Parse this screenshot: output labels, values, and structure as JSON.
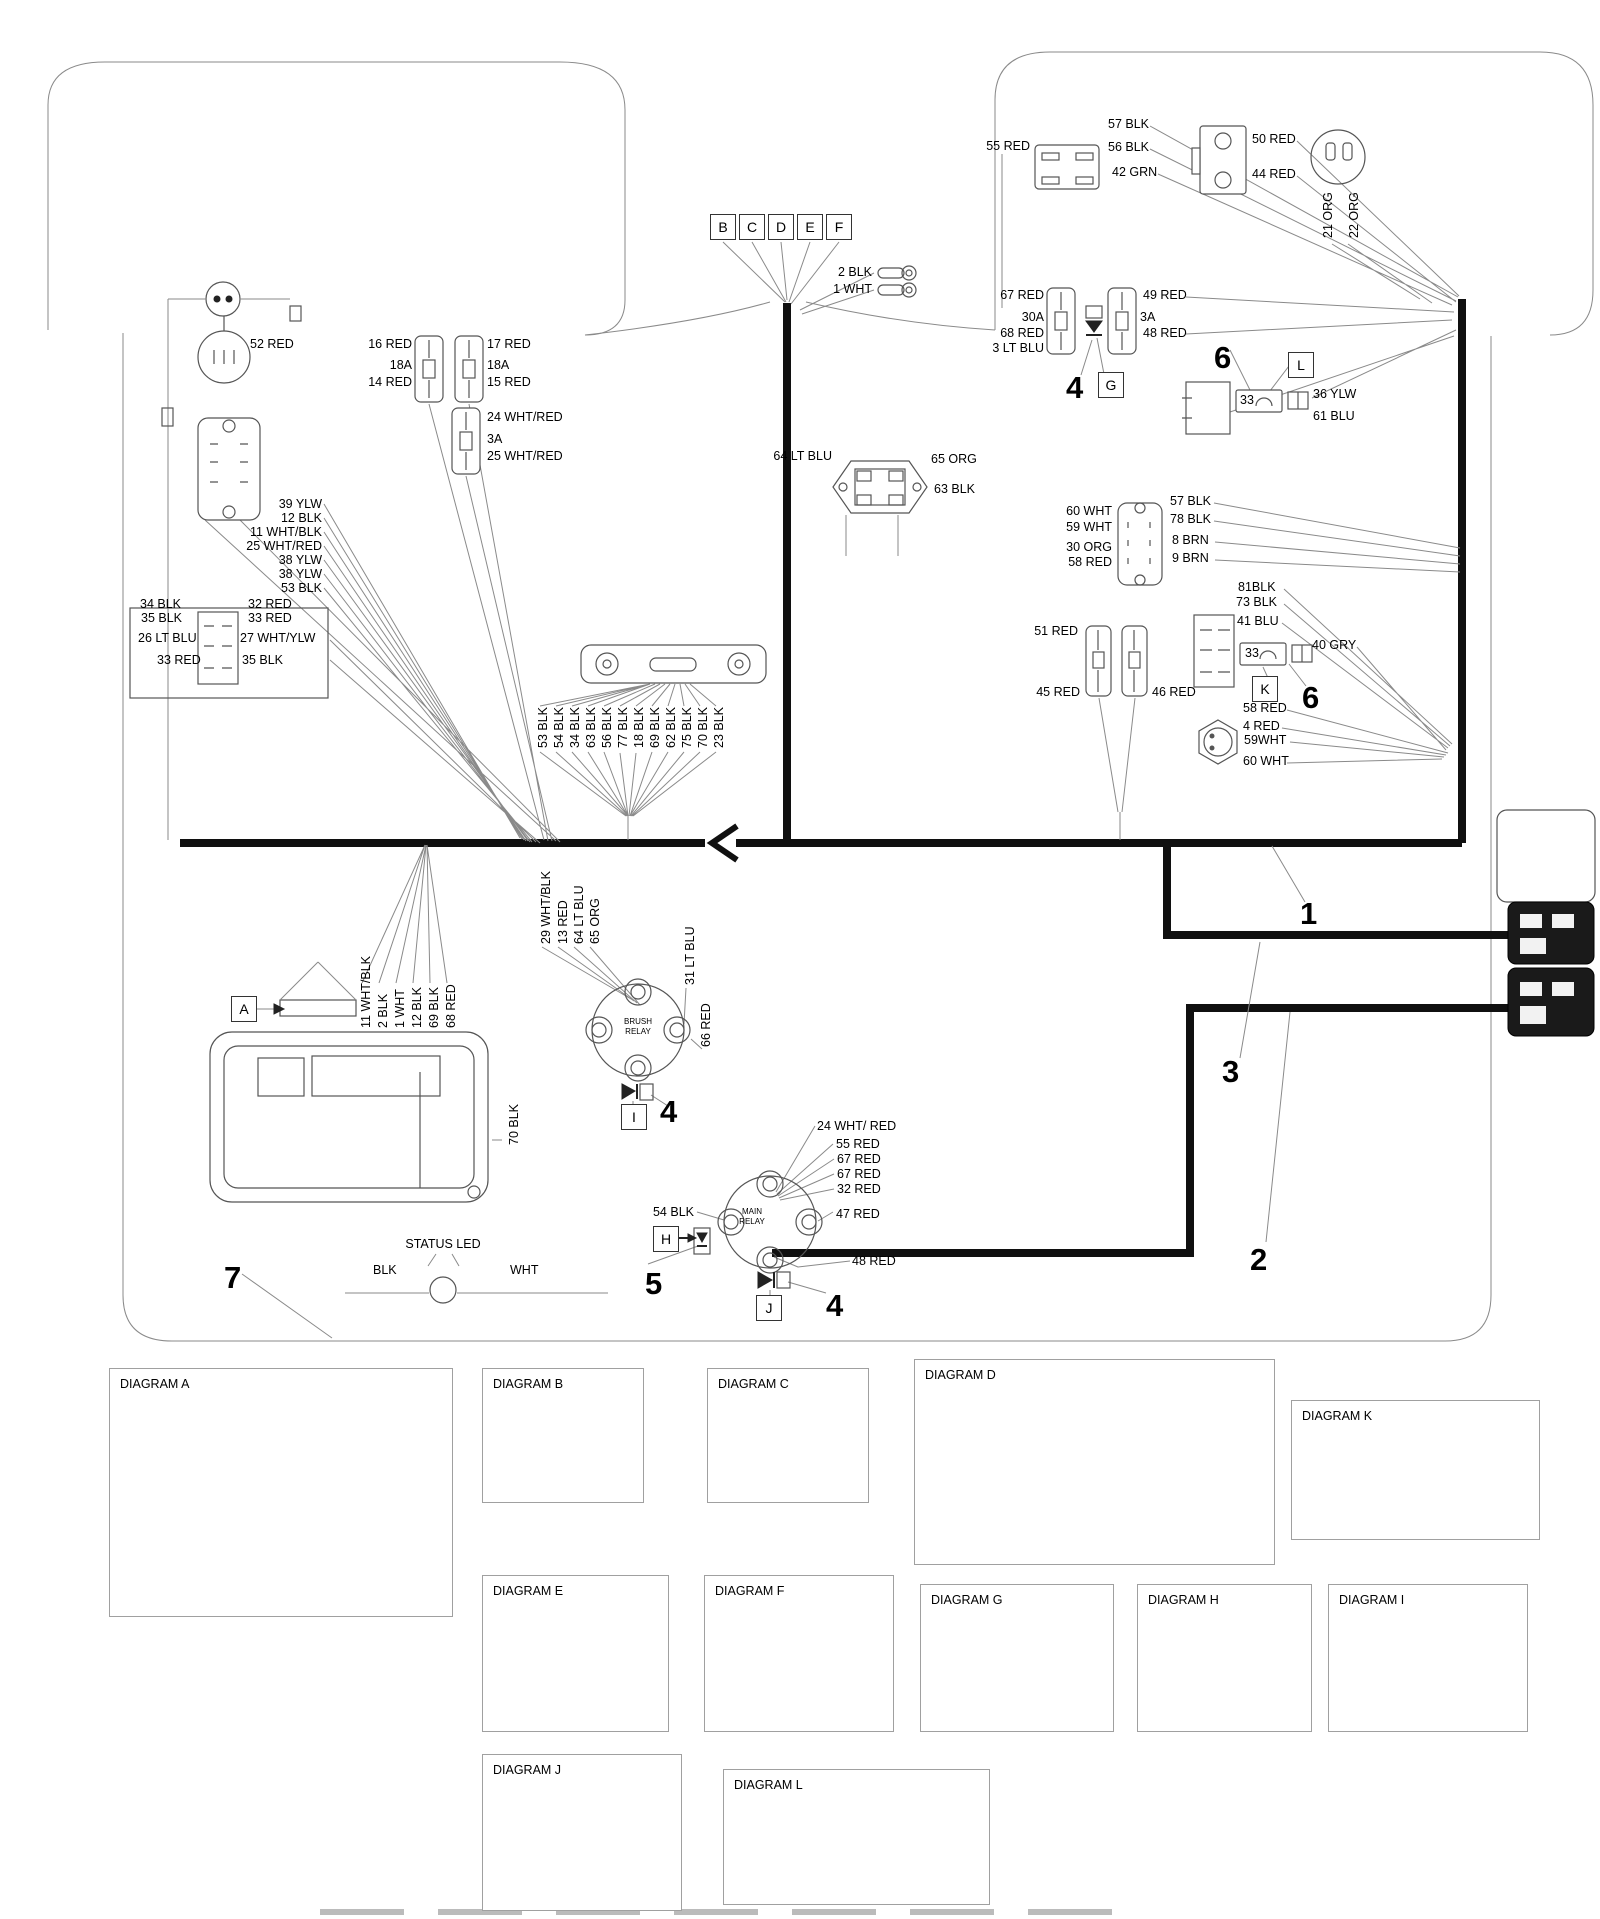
{
  "colors": {
    "thick_wire": "#101010",
    "thin_wire": "#8a8a8a",
    "text": "#000000",
    "background": "#ffffff"
  },
  "refs": [
    {
      "t": "A",
      "x": 231,
      "y": 996
    },
    {
      "t": "B",
      "x": 710,
      "y": 214
    },
    {
      "t": "C",
      "x": 739,
      "y": 214
    },
    {
      "t": "D",
      "x": 768,
      "y": 214
    },
    {
      "t": "E",
      "x": 797,
      "y": 214
    },
    {
      "t": "F",
      "x": 826,
      "y": 214
    },
    {
      "t": "G",
      "x": 1098,
      "y": 372
    },
    {
      "t": "H",
      "x": 653,
      "y": 1226
    },
    {
      "t": "I",
      "x": 621,
      "y": 1104
    },
    {
      "t": "J",
      "x": 756,
      "y": 1295
    },
    {
      "t": "K",
      "x": 1252,
      "y": 676
    },
    {
      "t": "L",
      "x": 1288,
      "y": 352
    }
  ],
  "labels": [
    {
      "t": "2 BLK",
      "x": 872,
      "y": 266,
      "a": "r"
    },
    {
      "t": "1 WHT",
      "x": 872,
      "y": 283,
      "a": "r"
    },
    {
      "t": "55 RED",
      "x": 1030,
      "y": 140,
      "a": "r"
    },
    {
      "t": "57 BLK",
      "x": 1108,
      "y": 118
    },
    {
      "t": "56 BLK",
      "x": 1108,
      "y": 141
    },
    {
      "t": "42 GRN",
      "x": 1112,
      "y": 166
    },
    {
      "t": "50 RED",
      "x": 1252,
      "y": 133
    },
    {
      "t": "44 RED",
      "x": 1252,
      "y": 168
    },
    {
      "t": "21 ORG",
      "x": 1322,
      "y": 238,
      "r": 1
    },
    {
      "t": "22 ORG",
      "x": 1348,
      "y": 238,
      "r": 1
    },
    {
      "t": "67 RED",
      "x": 1044,
      "y": 289,
      "a": "r"
    },
    {
      "t": "30A",
      "x": 1044,
      "y": 311,
      "a": "r"
    },
    {
      "t": "68 RED",
      "x": 1044,
      "y": 327,
      "a": "r"
    },
    {
      "t": "3 LT BLU",
      "x": 1044,
      "y": 342,
      "a": "r"
    },
    {
      "t": "49 RED",
      "x": 1143,
      "y": 289
    },
    {
      "t": "3A",
      "x": 1140,
      "y": 311
    },
    {
      "t": "48 RED",
      "x": 1143,
      "y": 327
    },
    {
      "t": "33",
      "x": 1240,
      "y": 394,
      "n": "fuse-33-label"
    },
    {
      "t": "36 YLW",
      "x": 1313,
      "y": 388
    },
    {
      "t": "61 BLU",
      "x": 1313,
      "y": 410
    },
    {
      "t": "64 LT BLU",
      "x": 832,
      "y": 450,
      "a": "r"
    },
    {
      "t": "65 ORG",
      "x": 931,
      "y": 453
    },
    {
      "t": "63 BLK",
      "x": 934,
      "y": 483
    },
    {
      "t": "60 WHT",
      "x": 1112,
      "y": 505,
      "a": "r"
    },
    {
      "t": "59 WHT",
      "x": 1112,
      "y": 521,
      "a": "r"
    },
    {
      "t": "30 ORG",
      "x": 1112,
      "y": 541,
      "a": "r"
    },
    {
      "t": "58 RED",
      "x": 1112,
      "y": 556,
      "a": "r"
    },
    {
      "t": "57 BLK",
      "x": 1170,
      "y": 495
    },
    {
      "t": "78 BLK",
      "x": 1170,
      "y": 513
    },
    {
      "t": "8 BRN",
      "x": 1172,
      "y": 534
    },
    {
      "t": "9 BRN",
      "x": 1172,
      "y": 552
    },
    {
      "t": "81BLK",
      "x": 1238,
      "y": 581
    },
    {
      "t": "73 BLK",
      "x": 1236,
      "y": 596
    },
    {
      "t": "41 BLU",
      "x": 1237,
      "y": 615
    },
    {
      "t": "33",
      "x": 1245,
      "y": 647,
      "n": "fuse-33-label"
    },
    {
      "t": "40 GRY",
      "x": 1312,
      "y": 639
    },
    {
      "t": "58 RED",
      "x": 1243,
      "y": 702
    },
    {
      "t": "4 RED",
      "x": 1243,
      "y": 720
    },
    {
      "t": "59WHT",
      "x": 1244,
      "y": 734
    },
    {
      "t": "60 WHT",
      "x": 1243,
      "y": 755
    },
    {
      "t": "51 RED",
      "x": 1078,
      "y": 625,
      "a": "r"
    },
    {
      "t": "45 RED",
      "x": 1080,
      "y": 686,
      "a": "r"
    },
    {
      "t": "46 RED",
      "x": 1152,
      "y": 686
    },
    {
      "t": "52 RED",
      "x": 250,
      "y": 338
    },
    {
      "t": "16 RED",
      "x": 412,
      "y": 338,
      "a": "r"
    },
    {
      "t": "18A",
      "x": 412,
      "y": 359,
      "a": "r"
    },
    {
      "t": "14 RED",
      "x": 412,
      "y": 376,
      "a": "r"
    },
    {
      "t": "17 RED",
      "x": 487,
      "y": 338
    },
    {
      "t": "18A",
      "x": 487,
      "y": 359
    },
    {
      "t": "15 RED",
      "x": 487,
      "y": 376
    },
    {
      "t": "24 WHT/RED",
      "x": 487,
      "y": 411
    },
    {
      "t": "3A",
      "x": 487,
      "y": 433
    },
    {
      "t": "25 WHT/RED",
      "x": 487,
      "y": 450
    },
    {
      "t": "39 YLW",
      "x": 322,
      "y": 498,
      "a": "r"
    },
    {
      "t": "12 BLK",
      "x": 322,
      "y": 512,
      "a": "r"
    },
    {
      "t": "11 WHT/BLK",
      "x": 322,
      "y": 526,
      "a": "r"
    },
    {
      "t": "25 WHT/RED",
      "x": 322,
      "y": 540,
      "a": "r"
    },
    {
      "t": "38 YLW",
      "x": 322,
      "y": 554,
      "a": "r"
    },
    {
      "t": "38 YLW",
      "x": 322,
      "y": 568,
      "a": "r"
    },
    {
      "t": "53 BLK",
      "x": 322,
      "y": 582,
      "a": "r"
    },
    {
      "t": "34 BLK",
      "x": 140,
      "y": 598
    },
    {
      "t": "35 BLK",
      "x": 141,
      "y": 612
    },
    {
      "t": "26 LT BLU",
      "x": 138,
      "y": 632
    },
    {
      "t": "33 RED",
      "x": 157,
      "y": 654
    },
    {
      "t": "32 RED",
      "x": 248,
      "y": 598
    },
    {
      "t": "33 RED",
      "x": 248,
      "y": 612
    },
    {
      "t": "27 WHT/YLW",
      "x": 240,
      "y": 632
    },
    {
      "t": "35 BLK",
      "x": 242,
      "y": 654
    },
    {
      "t": "53 BLK",
      "x": 537,
      "y": 748,
      "r": 1
    },
    {
      "t": "54 BLK",
      "x": 553,
      "y": 748,
      "r": 1
    },
    {
      "t": "34 BLK",
      "x": 569,
      "y": 748,
      "r": 1
    },
    {
      "t": "63 BLK",
      "x": 585,
      "y": 748,
      "r": 1
    },
    {
      "t": "56 BLK",
      "x": 601,
      "y": 748,
      "r": 1
    },
    {
      "t": "77 BLK",
      "x": 617,
      "y": 748,
      "r": 1
    },
    {
      "t": "18 BLK",
      "x": 633,
      "y": 748,
      "r": 1
    },
    {
      "t": "69 BLK",
      "x": 649,
      "y": 748,
      "r": 1
    },
    {
      "t": "62 BLK",
      "x": 665,
      "y": 748,
      "r": 1
    },
    {
      "t": "75 BLK",
      "x": 681,
      "y": 748,
      "r": 1
    },
    {
      "t": "70 BLK",
      "x": 697,
      "y": 748,
      "r": 1
    },
    {
      "t": "23 BLK",
      "x": 713,
      "y": 748,
      "r": 1
    },
    {
      "t": "11 WHT/BLK",
      "x": 360,
      "y": 1028,
      "r": 1
    },
    {
      "t": "2 BLK",
      "x": 377,
      "y": 1028,
      "r": 1
    },
    {
      "t": "1 WHT",
      "x": 394,
      "y": 1028,
      "r": 1
    },
    {
      "t": "12 BLK",
      "x": 411,
      "y": 1028,
      "r": 1
    },
    {
      "t": "69 BLK",
      "x": 428,
      "y": 1028,
      "r": 1
    },
    {
      "t": "68 RED",
      "x": 445,
      "y": 1028,
      "r": 1
    },
    {
      "t": "70 BLK",
      "x": 508,
      "y": 1145,
      "r": 1
    },
    {
      "t": "STATUS LED",
      "x": 443,
      "y": 1238,
      "a": "c",
      "n": "status-led-label"
    },
    {
      "t": "BLK",
      "x": 373,
      "y": 1264
    },
    {
      "t": "WHT",
      "x": 510,
      "y": 1264
    },
    {
      "t": "29 WHT/BLK",
      "x": 540,
      "y": 944,
      "r": 1
    },
    {
      "t": "13 RED",
      "x": 557,
      "y": 944,
      "r": 1
    },
    {
      "t": "64 LT BLU",
      "x": 573,
      "y": 944,
      "r": 1
    },
    {
      "t": "65 ORG",
      "x": 589,
      "y": 944,
      "r": 1
    },
    {
      "t": "31 LT BLU",
      "x": 684,
      "y": 985,
      "r": 1
    },
    {
      "t": "66 RED",
      "x": 700,
      "y": 1047,
      "r": 1
    },
    {
      "t": "BRUSH",
      "x": 638,
      "y": 1018,
      "cls": "tiny",
      "n": "brush-relay-label"
    },
    {
      "t": "RELAY",
      "x": 638,
      "y": 1028,
      "cls": "tiny",
      "n": "brush-relay-label"
    },
    {
      "t": "24 WHT/ RED",
      "x": 817,
      "y": 1120
    },
    {
      "t": "55 RED",
      "x": 836,
      "y": 1138
    },
    {
      "t": "67 RED",
      "x": 837,
      "y": 1153
    },
    {
      "t": "67 RED",
      "x": 837,
      "y": 1168
    },
    {
      "t": "32 RED",
      "x": 837,
      "y": 1183
    },
    {
      "t": "47 RED",
      "x": 836,
      "y": 1208
    },
    {
      "t": "54 BLK",
      "x": 694,
      "y": 1206,
      "a": "r"
    },
    {
      "t": "48 RED",
      "x": 852,
      "y": 1255
    },
    {
      "t": "MAIN",
      "x": 752,
      "y": 1208,
      "cls": "tiny",
      "n": "main-relay-label"
    },
    {
      "t": "RELAY",
      "x": 752,
      "y": 1218,
      "cls": "tiny",
      "n": "main-relay-label"
    },
    {
      "t": "1",
      "x": 1300,
      "y": 898,
      "cls": "big",
      "n": "callout-1"
    },
    {
      "t": "2",
      "x": 1250,
      "y": 1244,
      "cls": "big",
      "n": "callout-2"
    },
    {
      "t": "3",
      "x": 1222,
      "y": 1056,
      "cls": "big",
      "n": "callout-3"
    },
    {
      "t": "4",
      "x": 1066,
      "y": 372,
      "cls": "big",
      "n": "callout-4"
    },
    {
      "t": "4",
      "x": 660,
      "y": 1096,
      "cls": "big",
      "n": "callout-4"
    },
    {
      "t": "4",
      "x": 826,
      "y": 1290,
      "cls": "big",
      "n": "callout-4"
    },
    {
      "t": "5",
      "x": 645,
      "y": 1268,
      "cls": "big",
      "n": "callout-5"
    },
    {
      "t": "6",
      "x": 1214,
      "y": 342,
      "cls": "big",
      "n": "callout-6"
    },
    {
      "t": "6",
      "x": 1302,
      "y": 682,
      "cls": "big",
      "n": "callout-6"
    },
    {
      "t": "7",
      "x": 224,
      "y": 1262,
      "cls": "big",
      "n": "callout-7"
    },
    {
      "t": "80 WHT/GRN",
      "x": 280,
      "y": 1438,
      "a": "r"
    },
    {
      "t": "40 GRY",
      "x": 280,
      "y": 1453,
      "a": "r"
    },
    {
      "t": "72RED",
      "x": 280,
      "y": 1468,
      "a": "r"
    },
    {
      "t": "42 DK GRN",
      "x": 280,
      "y": 1483,
      "a": "r"
    },
    {
      "t": "28 WHT/ORG",
      "x": 280,
      "y": 1498,
      "a": "r"
    },
    {
      "t": "10 GRN",
      "x": 280,
      "y": 1513,
      "a": "r"
    },
    {
      "t": "41 DK BLU",
      "x": 280,
      "y": 1528,
      "a": "r"
    },
    {
      "t": "81 BLK",
      "x": 280,
      "y": 1543,
      "a": "r"
    },
    {
      "t": "36 YLW",
      "x": 354,
      "y": 1430
    },
    {
      "t": "31 LT BLU",
      "x": 354,
      "y": 1452
    },
    {
      "t": "43 RED",
      "x": 354,
      "y": 1472
    },
    {
      "t": "7 BRN",
      "x": 354,
      "y": 1493
    },
    {
      "t": "79 ORG",
      "x": 354,
      "y": 1512
    },
    {
      "t": "61 BLU",
      "x": 354,
      "y": 1538
    },
    {
      "t": "17 RED",
      "x": 580,
      "y": 1394
    },
    {
      "t": "19 BLK",
      "x": 580,
      "y": 1460
    },
    {
      "t": "16 RED",
      "x": 800,
      "y": 1394
    },
    {
      "t": "20 BLK",
      "x": 800,
      "y": 1460
    },
    {
      "t": "62 BLK",
      "x": 1063,
      "y": 1403,
      "a": "r"
    },
    {
      "t": "28 WHT/ORG",
      "x": 1063,
      "y": 1424,
      "a": "r"
    },
    {
      "t": "8 BRN",
      "x": 1063,
      "y": 1443,
      "a": "r"
    },
    {
      "t": "30 WHT",
      "x": 1063,
      "y": 1461,
      "a": "r"
    },
    {
      "t": "26 LT BLU",
      "x": 1063,
      "y": 1479,
      "a": "r"
    },
    {
      "t": "23 BLK",
      "x": 1063,
      "y": 1501,
      "a": "r"
    },
    {
      "t": "39 YLW",
      "x": 1170,
      "y": 1400
    },
    {
      "t": "29 WHT/BLK",
      "x": 1170,
      "y": 1421
    },
    {
      "t": "7 BRN",
      "x": 1172,
      "y": 1443
    },
    {
      "t": "78 BLK",
      "x": 1172,
      "y": 1461
    },
    {
      "t": "27 WHT/YLW",
      "x": 1170,
      "y": 1481
    },
    {
      "t": "22 ORG",
      "x": 1170,
      "y": 1501
    },
    {
      "t": "7",
      "x": 1090,
      "y": 1416
    },
    {
      "t": "6",
      "x": 1120,
      "y": 1416
    },
    {
      "t": "12",
      "x": 1082,
      "y": 1495
    },
    {
      "t": "1",
      "x": 1124,
      "y": 1495
    },
    {
      "t": "73 BLK",
      "x": 1363,
      "y": 1428,
      "a": "r"
    },
    {
      "t": "81BLK",
      "x": 1363,
      "y": 1456,
      "a": "r"
    },
    {
      "t": "41 BLU",
      "x": 1430,
      "y": 1426
    },
    {
      "t": "33",
      "x": 1426,
      "y": 1461,
      "n": "fuse-33-label"
    },
    {
      "t": "40 GRY",
      "x": 1492,
      "y": 1458
    },
    {
      "t": "67619",
      "x": 1424,
      "y": 1484
    },
    {
      "t": "3 BLU",
      "x": 532,
      "y": 1588,
      "a": "r"
    },
    {
      "t": "4 RED",
      "x": 532,
      "y": 1606,
      "a": "r"
    },
    {
      "t": "10 GRN",
      "x": 616,
      "y": 1588
    },
    {
      "t": "9 BRN",
      "x": 616,
      "y": 1606
    },
    {
      "t": "5 ORG",
      "x": 616,
      "y": 1624
    },
    {
      "t": "4",
      "x": 549,
      "y": 1585
    },
    {
      "t": "3",
      "x": 583,
      "y": 1585
    },
    {
      "t": "6",
      "x": 547,
      "y": 1621
    },
    {
      "t": "1",
      "x": 585,
      "y": 1623
    },
    {
      "t": "77 BLK",
      "x": 753,
      "y": 1586,
      "a": "r"
    },
    {
      "t": "72 RED",
      "x": 753,
      "y": 1604,
      "a": "r"
    },
    {
      "t": "76 RED",
      "x": 753,
      "y": 1622,
      "a": "r"
    },
    {
      "t": "74 RED",
      "x": 840,
      "y": 1586
    },
    {
      "t": "73 BLK",
      "x": 840,
      "y": 1604
    },
    {
      "t": "75 BLK",
      "x": 840,
      "y": 1622
    },
    {
      "t": "4",
      "x": 757,
      "y": 1583
    },
    {
      "t": "3",
      "x": 788,
      "y": 1583
    },
    {
      "t": "6",
      "x": 755,
      "y": 1619
    },
    {
      "t": "1",
      "x": 790,
      "y": 1621
    },
    {
      "t": "29273",
      "x": 1178,
      "y": 1690,
      "r": 1
    },
    {
      "t": "MAIN",
      "x": 1245,
      "y": 1650,
      "cls": "tiny",
      "n": "main-relay-label"
    },
    {
      "t": "RELAY",
      "x": 1245,
      "y": 1659,
      "cls": "tiny",
      "n": "main-relay-label"
    },
    {
      "t": "BRUSH",
      "x": 1424,
      "y": 1636,
      "cls": "tiny",
      "n": "brush-relay-label"
    },
    {
      "t": "RELAY",
      "x": 1424,
      "y": 1645,
      "cls": "tiny",
      "n": "brush-relay-label"
    },
    {
      "t": "29204",
      "x": 1400,
      "y": 1714
    },
    {
      "t": "MAIN",
      "x": 578,
      "y": 1810,
      "cls": "tiny",
      "n": "main-relay-label"
    },
    {
      "t": "RELAY",
      "x": 578,
      "y": 1820,
      "cls": "tiny",
      "n": "main-relay-label"
    },
    {
      "t": "29204",
      "x": 556,
      "y": 1882
    },
    {
      "t": "33",
      "x": 804,
      "y": 1816,
      "n": "fuse-33-label"
    },
    {
      "t": "36 YLW",
      "x": 878,
      "y": 1810
    },
    {
      "t": "67619",
      "x": 800,
      "y": 1842
    },
    {
      "t": "61 BLU",
      "x": 878,
      "y": 1838
    }
  ],
  "diagrams": [
    {
      "id": "a",
      "title": "DIAGRAM A",
      "x": 109,
      "y": 1368,
      "w": 342,
      "h": 247
    },
    {
      "id": "b",
      "title": "DIAGRAM B",
      "x": 482,
      "y": 1368,
      "w": 160,
      "h": 133
    },
    {
      "id": "c",
      "title": "DIAGRAM C",
      "x": 707,
      "y": 1368,
      "w": 160,
      "h": 133
    },
    {
      "id": "d",
      "title": "DIAGRAM D",
      "x": 914,
      "y": 1359,
      "w": 359,
      "h": 204
    },
    {
      "id": "k",
      "title": "DIAGRAM K",
      "x": 1291,
      "y": 1400,
      "w": 247,
      "h": 138
    },
    {
      "id": "e",
      "title": "DIAGRAM E",
      "x": 482,
      "y": 1575,
      "w": 185,
      "h": 155
    },
    {
      "id": "f",
      "title": "DIAGRAM F",
      "x": 704,
      "y": 1575,
      "w": 188,
      "h": 155
    },
    {
      "id": "g",
      "title": "DIAGRAM G",
      "x": 920,
      "y": 1584,
      "w": 192,
      "h": 146
    },
    {
      "id": "h",
      "title": "DIAGRAM H",
      "x": 1137,
      "y": 1584,
      "w": 173,
      "h": 146
    },
    {
      "id": "i",
      "title": "DIAGRAM I",
      "x": 1328,
      "y": 1584,
      "w": 198,
      "h": 146
    },
    {
      "id": "j",
      "title": "DIAGRAM J",
      "x": 482,
      "y": 1754,
      "w": 198,
      "h": 155
    },
    {
      "id": "l",
      "title": "DIAGRAM L",
      "x": 723,
      "y": 1769,
      "w": 265,
      "h": 134
    }
  ]
}
